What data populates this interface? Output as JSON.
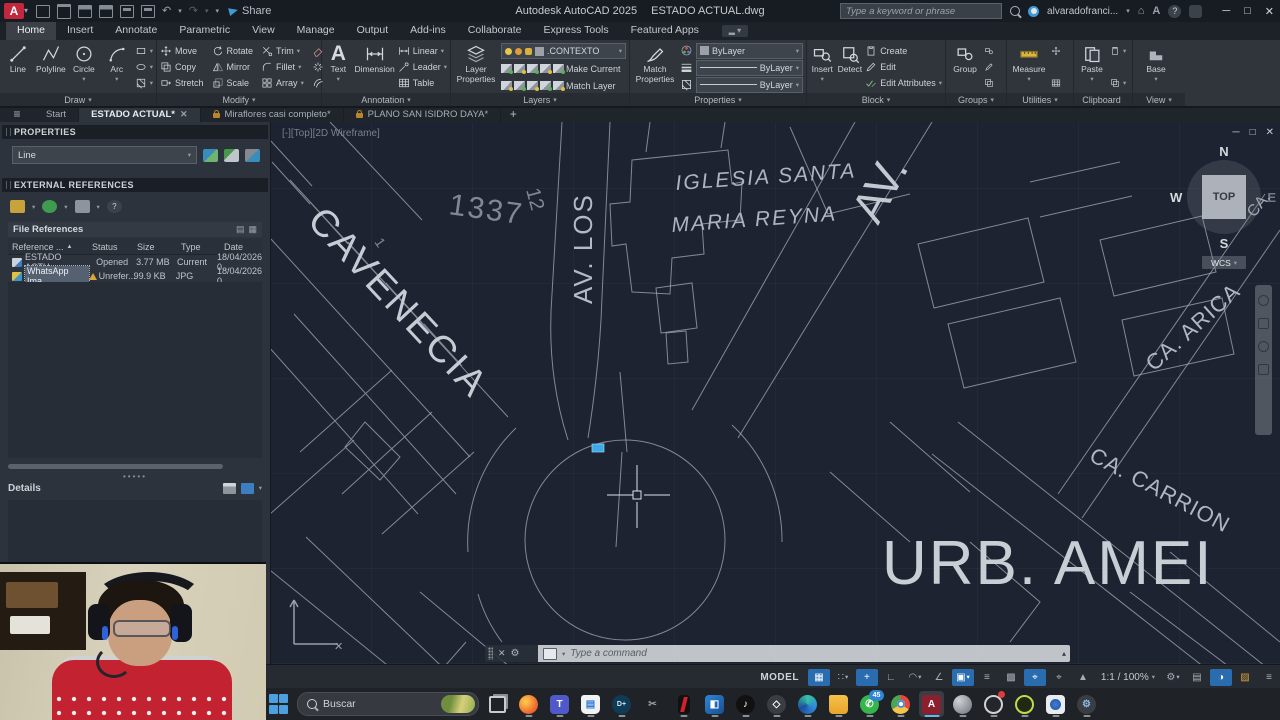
{
  "titlebar": {
    "app": "Autodesk AutoCAD 2025",
    "doc": "ESTADO ACTUAL.dwg",
    "share": "Share",
    "search_placeholder": "Type a keyword or phrase",
    "user": "alvaradofranci...",
    "accent": "#c2273d"
  },
  "tabs": {
    "items": [
      "Home",
      "Insert",
      "Annotate",
      "Parametric",
      "View",
      "Manage",
      "Output",
      "Add-ins",
      "Collaborate",
      "Express Tools",
      "Featured Apps"
    ],
    "active": "Home"
  },
  "ribbon": {
    "draw": {
      "label": "Draw",
      "line": "Line",
      "polyline": "Polyline",
      "circle": "Circle",
      "arc": "Arc"
    },
    "modify": {
      "label": "Modify",
      "items": [
        "Move",
        "Rotate",
        "Trim",
        "Copy",
        "Mirror",
        "Fillet",
        "Stretch",
        "Scale",
        "Array"
      ]
    },
    "annotation": {
      "label": "Annotation",
      "text": "Text",
      "dimension": "Dimension",
      "linear": "Linear",
      "leader": "Leader",
      "table": "Table"
    },
    "layers": {
      "label": "Layers",
      "layer_properties": "Layer Properties",
      "current": ".CONTEXTO",
      "make_current": "Make Current",
      "match_layer": "Match Layer"
    },
    "props": {
      "label": "Properties",
      "match": "Match Properties",
      "color": "ByLayer",
      "lineweight": "ByLayer",
      "linetype": "ByLayer"
    },
    "block": {
      "label": "Block",
      "insert": "Insert",
      "detect": "Detect",
      "create": "Create",
      "edit": "Edit",
      "edit_attributes": "Edit Attributes"
    },
    "groups": {
      "label": "Groups",
      "group": "Group"
    },
    "utilities": {
      "label": "Utilities",
      "measure": "Measure"
    },
    "clipboard": {
      "label": "Clipboard",
      "paste": "Paste"
    },
    "view": {
      "label": "View",
      "base": "Base"
    }
  },
  "filetabs": {
    "start": "Start",
    "t1": "ESTADO ACTUAL*",
    "t2": "Miraflores casi completo*",
    "t3": "PLANO SAN ISIDRO DAYA*"
  },
  "palette": {
    "properties_title": "PROPERTIES",
    "selector": "Line",
    "xref_title": "EXTERNAL REFERENCES",
    "file_refs": "File References",
    "cols": [
      "Reference ...",
      "Status",
      "Size",
      "Type",
      "Date"
    ],
    "rows": [
      {
        "name": "ESTADO ACTU...",
        "status": "Opened",
        "size": "3.77 MB",
        "type": "Current",
        "date": "18/04/2026 0..."
      },
      {
        "name": "WhatsApp Ima...",
        "status": "Unrefer...",
        "size": "99.9 KB",
        "type": "JPG",
        "date": "18/04/2026 0..."
      }
    ],
    "details": "Details"
  },
  "canvas": {
    "viewport": "[-][Top][2D Wireframe]",
    "labels": {
      "cavenecia": "CAVENECIA",
      "n1337": "1337",
      "n12": "12",
      "n1": "1",
      "av_los": "AV. LOS",
      "av": "AV.",
      "iglesia1": "IGLESIA  SANTA",
      "iglesia2": "MARIA  REYNA",
      "ca_arica": "CA. ARICA",
      "ca_carrion": "CA. CARRION",
      "urb": "URB. AMEI",
      "ca": "CA."
    },
    "viewcube": {
      "n": "N",
      "w": "W",
      "s": "S",
      "e": "E",
      "top": "TOP",
      "wcs": "WCS"
    }
  },
  "cmd": {
    "placeholder": "Type a command"
  },
  "status": {
    "model": "MODEL",
    "scale": "1:1 / 100%"
  },
  "taskbar": {
    "search": "Buscar",
    "wa_badge": "45",
    "lang1": "ESP",
    "lang2": "LAA",
    "time": "04:35 p. m.",
    "date": "18/04/2026"
  }
}
